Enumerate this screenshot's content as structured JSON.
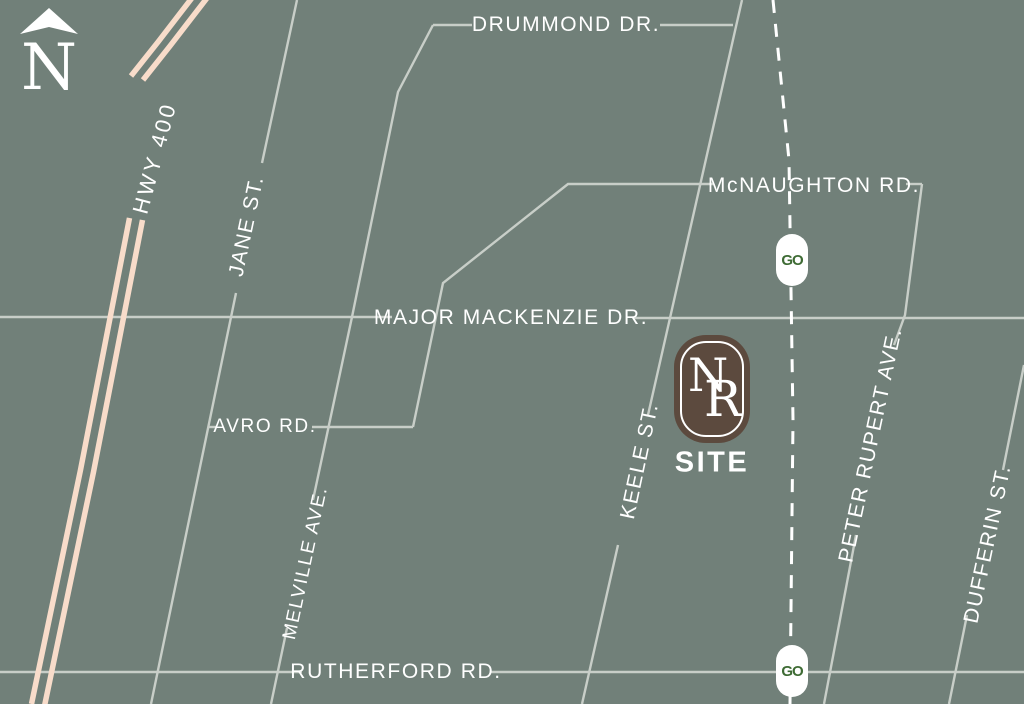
{
  "compass": {
    "label": "N"
  },
  "roads": {
    "hwy400": "HWY 400",
    "drummond": "DRUMMOND DR.",
    "jane": "JANE ST.",
    "mcnaughton": "McNAUGHTON RD.",
    "major_mackenzie": "MAJOR MACKENZIE DR.",
    "avro": "AVRO RD.",
    "melville": "MELVILLE AVE.",
    "keele": "KEELE ST.",
    "peter_rupert": "PETER RUPERT AVE.",
    "dufferin": "DUFFERIN ST.",
    "rutherford": "RUTHERFORD RD."
  },
  "site": {
    "monogram_left": "N",
    "monogram_right": "R",
    "label": "SITE"
  },
  "transit": {
    "logo": "GO",
    "stations": 2
  },
  "colors": {
    "background": "#718079",
    "road": "#C8CEC8",
    "highway": "#F8DCCA",
    "railway": "#FFFFFF",
    "site_badge": "#5C4A3E",
    "go_green": "#3E6B34",
    "label_text": "#FFFFFF"
  }
}
